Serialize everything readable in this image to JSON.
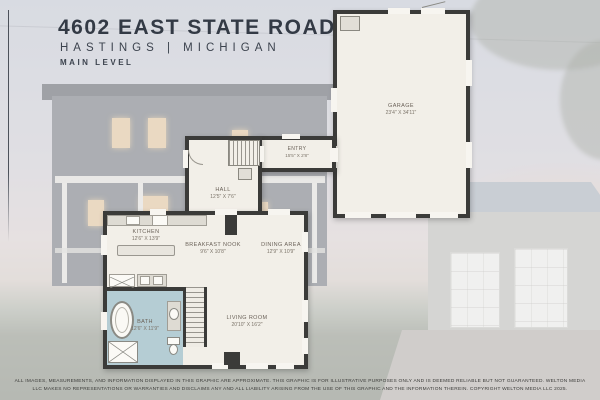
{
  "header": {
    "address": "4602 EAST STATE ROAD",
    "location": "HASTINGS  |  MICHIGAN",
    "level": "MAIN LEVEL"
  },
  "rooms": {
    "garage": {
      "name": "GARAGE",
      "dims": "23'4\" X 34'11\""
    },
    "entry": {
      "name": "ENTRY",
      "dims": "15'5\" X 2'8\""
    },
    "hall": {
      "name": "HALL",
      "dims": "12'5\" X 7'6\""
    },
    "kitchen": {
      "name": "KITCHEN",
      "dims": "12'6\" X 13'9\""
    },
    "breakfast_nook": {
      "name": "BREAKFAST NOOK",
      "dims": "9'6\" X 10'8\""
    },
    "dining_area": {
      "name": "DINING AREA",
      "dims": "12'9\" X 10'9\""
    },
    "bath": {
      "name": "BATH",
      "dims": "12'6\" X 11'9\""
    },
    "living_room": {
      "name": "LIVING ROOM",
      "dims": "20'10\" X 16'2\""
    }
  },
  "disclaimer": "ALL IMAGES, MEASUREMENTS, AND INFORMATION DISPLAYED IN THIS GRAPHIC ARE APPROXIMATE. THIS GRAPHIC IS FOR ILLUSTRATIVE PURPOSES ONLY AND IS DEEMED RELIABLE BUT NOT GUARANTEED. WELTON MEDIA LLC MAKES NO REPRESENTATIONS OR WARRANTIES AND DISCLAIMS ANY AND ALL LIABILITY ARISING FROM THE USE OF THIS GRAPHIC AND THE INFORMATION THEREIN. COPYRIGHT WELTON MEDIA LLC 2025.",
  "colors": {
    "wall": "#3b3b39",
    "floor": "#f2efe8",
    "bath_floor": "#b5cdd4",
    "header_text": "#333a45",
    "label_text": "#6b6259"
  }
}
